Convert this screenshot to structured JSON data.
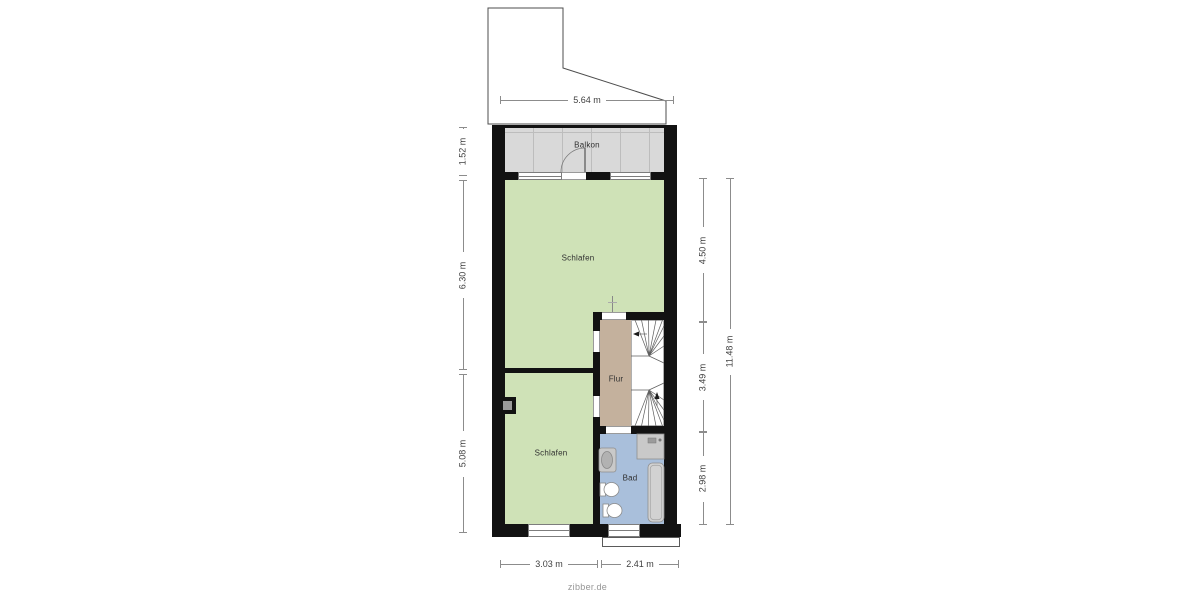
{
  "watermark": "zibber.de",
  "rooms": {
    "balkon": "Balkon",
    "schlafen_top": "Schlafen",
    "schlafen_bottom": "Schlafen",
    "flur": "Flur",
    "bad": "Bad"
  },
  "dimensions": {
    "top_width": "5.64 m",
    "balcony_depth": "1.52 m",
    "upper_room_depth": "6.30 m",
    "lower_room_depth": "5.08 m",
    "right_upper": "4.50 m",
    "right_middle": "3.49 m",
    "right_lower": "2.98 m",
    "right_total": "11.48 m",
    "bottom_left": "3.03 m",
    "bottom_right": "2.41 m"
  },
  "colors": {
    "room": "#cfe2b7",
    "hallway": "#c4b19d",
    "bathroom": "#a9bfdb",
    "balcony": "#d9d9d9",
    "wall": "#121212"
  }
}
